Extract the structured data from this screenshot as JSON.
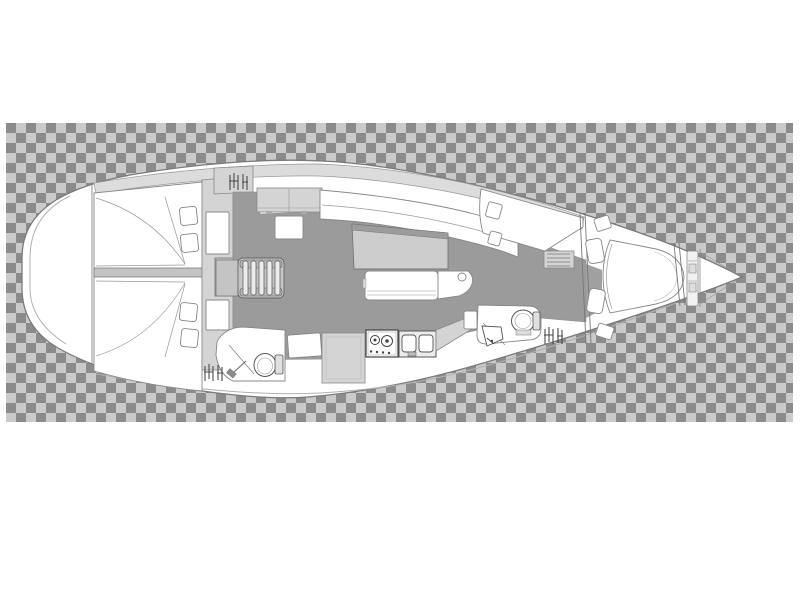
{
  "meta": {
    "title": "Sailing yacht interior layout plan (top view)",
    "view": "deck / accommodation plan, bow pointing right",
    "background": "transparency checkerboard band",
    "text_content": "none visible in image"
  },
  "colors": {
    "checker_light": "#cacaca",
    "checker_dark": "#8b8b8b",
    "hull_fill": "#ffffff",
    "outline": "#7a7a7a",
    "deck_band": "#dcdcdc",
    "floor": "#9b9b9b",
    "furniture_light": "#d4d4d4",
    "furniture_mid": "#c4c4c4"
  },
  "components": [
    {
      "id": "checkerboard-background",
      "label": "transparency checker band"
    },
    {
      "id": "hull",
      "label": "yacht hull outline, bow to the right"
    },
    {
      "id": "stern-deck",
      "label": "rounded transom / stern deck"
    },
    {
      "id": "aft-cabin-port",
      "label": "aft double cabin with berth and two pillows"
    },
    {
      "id": "aft-cabin-starboard",
      "label": "aft double cabin with berth and two pillows"
    },
    {
      "id": "companionway-steps",
      "label": "companionway ladder with treads"
    },
    {
      "id": "overhead-lockers",
      "label": "two-door locker unit"
    },
    {
      "id": "salon-floor",
      "label": "salon and corridor sole"
    },
    {
      "id": "salon-settee-starboard",
      "label": "L-shaped salon settee"
    },
    {
      "id": "salon-table",
      "label": "folding salon table"
    },
    {
      "id": "salon-settee-center",
      "label": "centerline bench seat"
    },
    {
      "id": "galley-cabinet",
      "label": "galley cabinet"
    },
    {
      "id": "galley-stove",
      "label": "two-burner stove"
    },
    {
      "id": "galley-sinks",
      "label": "double sink unit"
    },
    {
      "id": "aft-head",
      "label": "aft head with toilet and shower"
    },
    {
      "id": "forward-head",
      "label": "forward head with toilet and sink"
    },
    {
      "id": "forward-sofa",
      "label": "starboard forward seat with hatches"
    },
    {
      "id": "v-berth",
      "label": "forward cabin V-berth with two pillows"
    },
    {
      "id": "forward-bulkhead",
      "label": "forward cabin bulkhead"
    },
    {
      "id": "anchor-windlass",
      "label": "anchor locker / windlass area"
    },
    {
      "id": "vent-grille-icon",
      "label": "technical vent glyph (3 instances)"
    },
    {
      "id": "shelf-locker",
      "label": "shelved locker"
    }
  ]
}
